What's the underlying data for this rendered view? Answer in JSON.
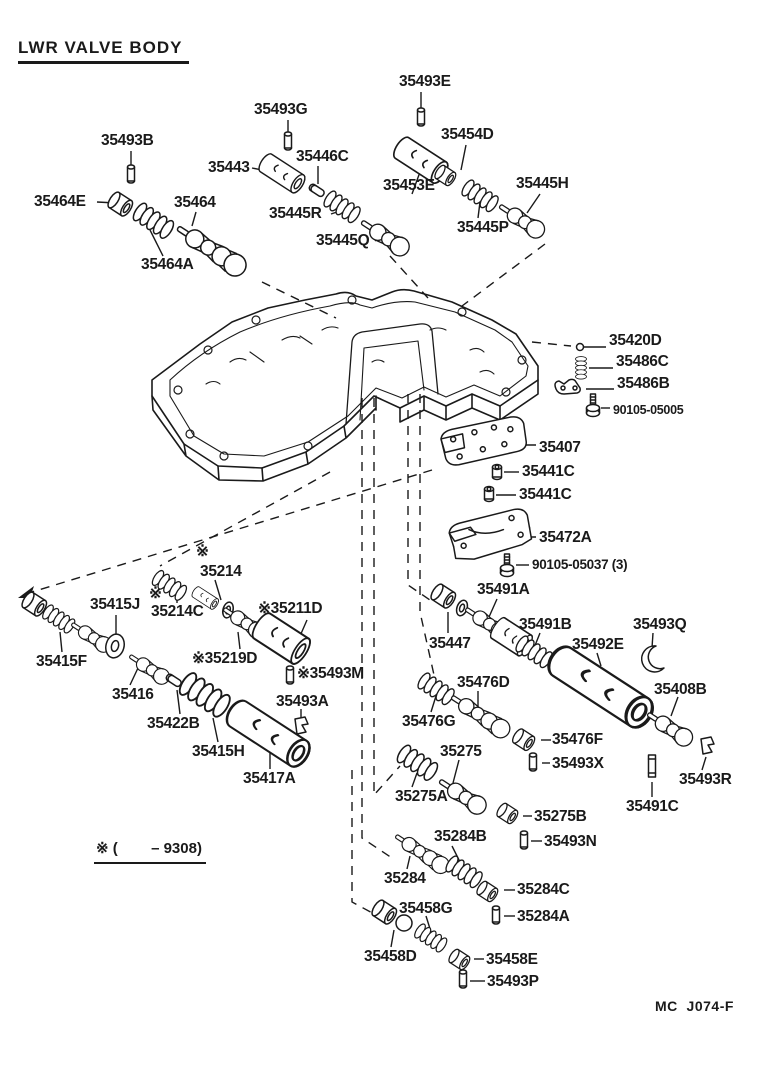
{
  "page": {
    "title": "LWR VALVE BODY",
    "footnote": "※ (        – 9308)",
    "doc_code": "MC  J074-F",
    "ink_color": "#1a1a1a",
    "paper_color": "#ffffff"
  },
  "labels": [
    {
      "t": "35493B",
      "x": 101,
      "y": 133
    },
    {
      "t": "35464E",
      "x": 34,
      "y": 194
    },
    {
      "t": "35464",
      "x": 174,
      "y": 195
    },
    {
      "t": "35464A",
      "x": 141,
      "y": 257
    },
    {
      "t": "35493G",
      "x": 254,
      "y": 102
    },
    {
      "t": "35443",
      "x": 208,
      "y": 160
    },
    {
      "t": "35446C",
      "x": 296,
      "y": 149
    },
    {
      "t": "35445R",
      "x": 269,
      "y": 206
    },
    {
      "t": "35445Q",
      "x": 316,
      "y": 233
    },
    {
      "t": "35493E",
      "x": 399,
      "y": 74
    },
    {
      "t": "35454D",
      "x": 441,
      "y": 127
    },
    {
      "t": "35453E",
      "x": 383,
      "y": 178
    },
    {
      "t": "35445H",
      "x": 516,
      "y": 176
    },
    {
      "t": "35445P",
      "x": 457,
      "y": 220
    },
    {
      "t": "35420D",
      "x": 609,
      "y": 333
    },
    {
      "t": "35486C",
      "x": 616,
      "y": 354
    },
    {
      "t": "35486B",
      "x": 617,
      "y": 376
    },
    {
      "t": "90105-05005",
      "x": 613,
      "y": 404,
      "fs": 12.5
    },
    {
      "t": "35407",
      "x": 539,
      "y": 440
    },
    {
      "t": "35441C",
      "x": 522,
      "y": 464
    },
    {
      "t": "35441C",
      "x": 519,
      "y": 487
    },
    {
      "t": "35472A",
      "x": 539,
      "y": 530
    },
    {
      "t": "90105-05037 (3)",
      "x": 532,
      "y": 558,
      "fs": 13.5
    },
    {
      "t": "※",
      "x": 196,
      "y": 544
    },
    {
      "t": "35214",
      "x": 200,
      "y": 564
    },
    {
      "t": "35415J",
      "x": 90,
      "y": 597
    },
    {
      "t": "※",
      "x": 149,
      "y": 586
    },
    {
      "t": "35214C",
      "x": 151,
      "y": 604
    },
    {
      "t": "※35211D",
      "x": 258,
      "y": 601
    },
    {
      "t": "35415F",
      "x": 36,
      "y": 654
    },
    {
      "t": "※35219D",
      "x": 192,
      "y": 651
    },
    {
      "t": "※35493M",
      "x": 297,
      "y": 666
    },
    {
      "t": "35416",
      "x": 112,
      "y": 687
    },
    {
      "t": "35493A",
      "x": 276,
      "y": 694
    },
    {
      "t": "35422B",
      "x": 147,
      "y": 716
    },
    {
      "t": "35415H",
      "x": 192,
      "y": 744
    },
    {
      "t": "35417A",
      "x": 243,
      "y": 771
    },
    {
      "t": "35491A",
      "x": 477,
      "y": 582
    },
    {
      "t": "35447",
      "x": 429,
      "y": 636
    },
    {
      "t": "35491B",
      "x": 519,
      "y": 617
    },
    {
      "t": "35493Q",
      "x": 633,
      "y": 617
    },
    {
      "t": "35492E",
      "x": 572,
      "y": 637
    },
    {
      "t": "35408B",
      "x": 654,
      "y": 682
    },
    {
      "t": "35476D",
      "x": 457,
      "y": 675
    },
    {
      "t": "35476G",
      "x": 402,
      "y": 714
    },
    {
      "t": "35476F",
      "x": 552,
      "y": 732
    },
    {
      "t": "35493X",
      "x": 552,
      "y": 756
    },
    {
      "t": "35275",
      "x": 440,
      "y": 744
    },
    {
      "t": "35275A",
      "x": 395,
      "y": 789
    },
    {
      "t": "35275B",
      "x": 534,
      "y": 809
    },
    {
      "t": "35493N",
      "x": 544,
      "y": 834
    },
    {
      "t": "35284B",
      "x": 434,
      "y": 829
    },
    {
      "t": "35284",
      "x": 384,
      "y": 871
    },
    {
      "t": "35284C",
      "x": 517,
      "y": 882
    },
    {
      "t": "35284A",
      "x": 517,
      "y": 909
    },
    {
      "t": "35458G",
      "x": 399,
      "y": 901
    },
    {
      "t": "35458D",
      "x": 364,
      "y": 949
    },
    {
      "t": "35458E",
      "x": 486,
      "y": 952
    },
    {
      "t": "35493P",
      "x": 487,
      "y": 974
    },
    {
      "t": "35491C",
      "x": 626,
      "y": 799
    },
    {
      "t": "35493R",
      "x": 679,
      "y": 772
    }
  ]
}
